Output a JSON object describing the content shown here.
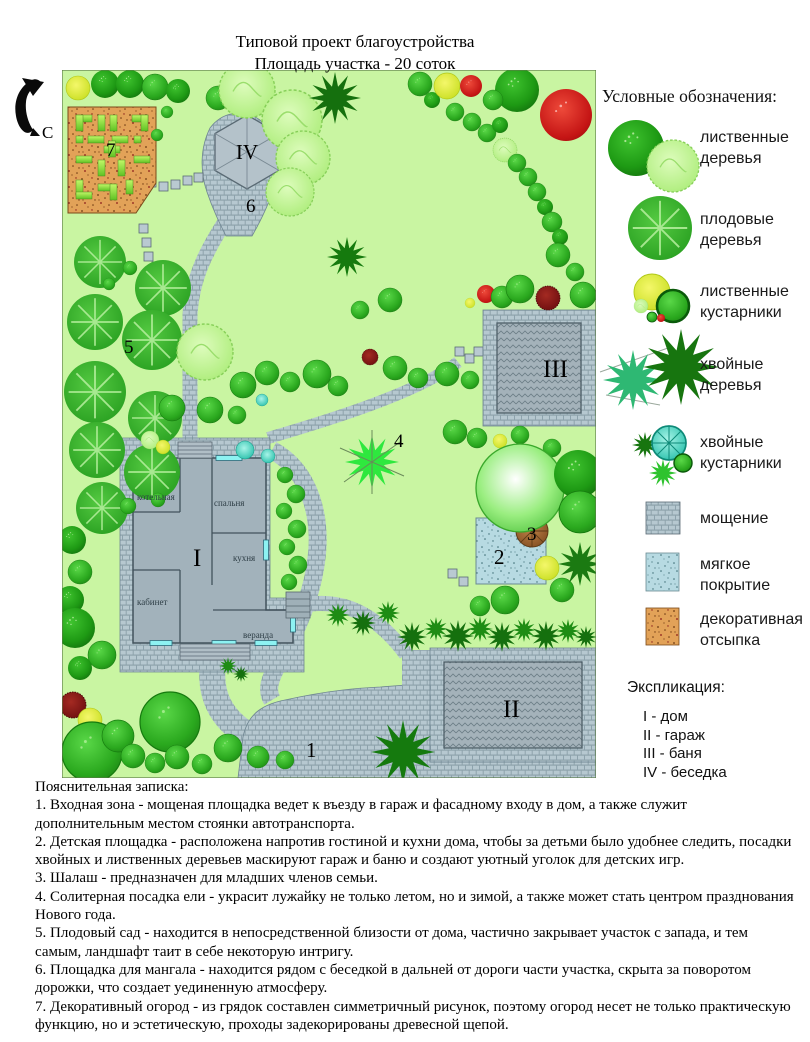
{
  "title": {
    "line1": "Типовой проект благоустройства",
    "line2": "Площадь участка - 20 соток"
  },
  "north_label": "С",
  "legend": {
    "header": "Условные обозначения:",
    "items": [
      {
        "icon": "deciduous-trees",
        "line1": "лиственные",
        "line2": "деревья"
      },
      {
        "icon": "fruit-trees",
        "line1": "плодовые",
        "line2": "деревья"
      },
      {
        "icon": "deciduous-shrubs",
        "line1": "лиственные",
        "line2": "кустарники"
      },
      {
        "icon": "conifer-trees",
        "line1": "хвойные",
        "line2": "деревья"
      },
      {
        "icon": "conifer-shrubs",
        "line1": "хвойные",
        "line2": "кустарники"
      },
      {
        "icon": "paving",
        "line1": "мощение",
        "line2": ""
      },
      {
        "icon": "soft-surface",
        "line1": "мягкое",
        "line2": "покрытие"
      },
      {
        "icon": "decorative-mulch",
        "line1": "декоративная",
        "line2": "отсыпка"
      }
    ]
  },
  "explication": {
    "header": "Экспликация:",
    "items": [
      "I - дом",
      "II - гараж",
      "III - баня",
      "IV - беседка"
    ]
  },
  "plan": {
    "numbers": {
      "entrance": "1",
      "playground": "2",
      "shalash": "3",
      "spruce": "4",
      "orchard": "5",
      "bbq": "6",
      "kitchen_garden": "7"
    },
    "buildings": {
      "house": "I",
      "garage": "II",
      "bath": "III",
      "gazebo": "IV"
    },
    "rooms": {
      "boiler": "котельная",
      "bedroom": "спальня",
      "kitchen": "кухня",
      "study": "кабинет",
      "veranda": "веранда"
    },
    "colors": {
      "lawn": "#c9f5a2",
      "paving": "#b6c8d0",
      "building": "#a2b2bb",
      "soft_cover": "#b7dae2",
      "decorative_fill": "#e2a258",
      "window": "#8df2f2"
    }
  },
  "notes": {
    "header": "Пояснительная записка:",
    "items": [
      "1. Входная зона - мощеная площадка ведет к въезду в гараж и фасадному входу в дом, а также служит дополнительным местом стоянки автотранспорта.",
      "2. Детская площадка - расположена напротив гостиной и кухни дома, чтобы за детьми было удобнее следить, посадки хвойных и лиственных деревьев маскируют гараж и баню и создают уютный уголок для детских игр.",
      "3. Шалаш - предназначен для младших членов семьи.",
      "4. Солитерная посадка ели - украсит лужайку не только летом, но и зимой, а также может стать центром празднования Нового года.",
      "5. Плодовый сад - находится в непосредственной близости от дома, частично закрывает участок с запада, и тем самым, ландшафт таит в себе некоторую интригу.",
      "6. Площадка для мангала - находится рядом с беседкой в дальней от дороги части участка, скрыта за поворотом дорожки, что создает уединенную атмосферу.",
      "7. Декоративный огород - из грядок составлен симметричный рисунок, поэтому огород несет не только практическую функцию, но и эстетическую, проходы задекорированы древесной щепой."
    ]
  }
}
